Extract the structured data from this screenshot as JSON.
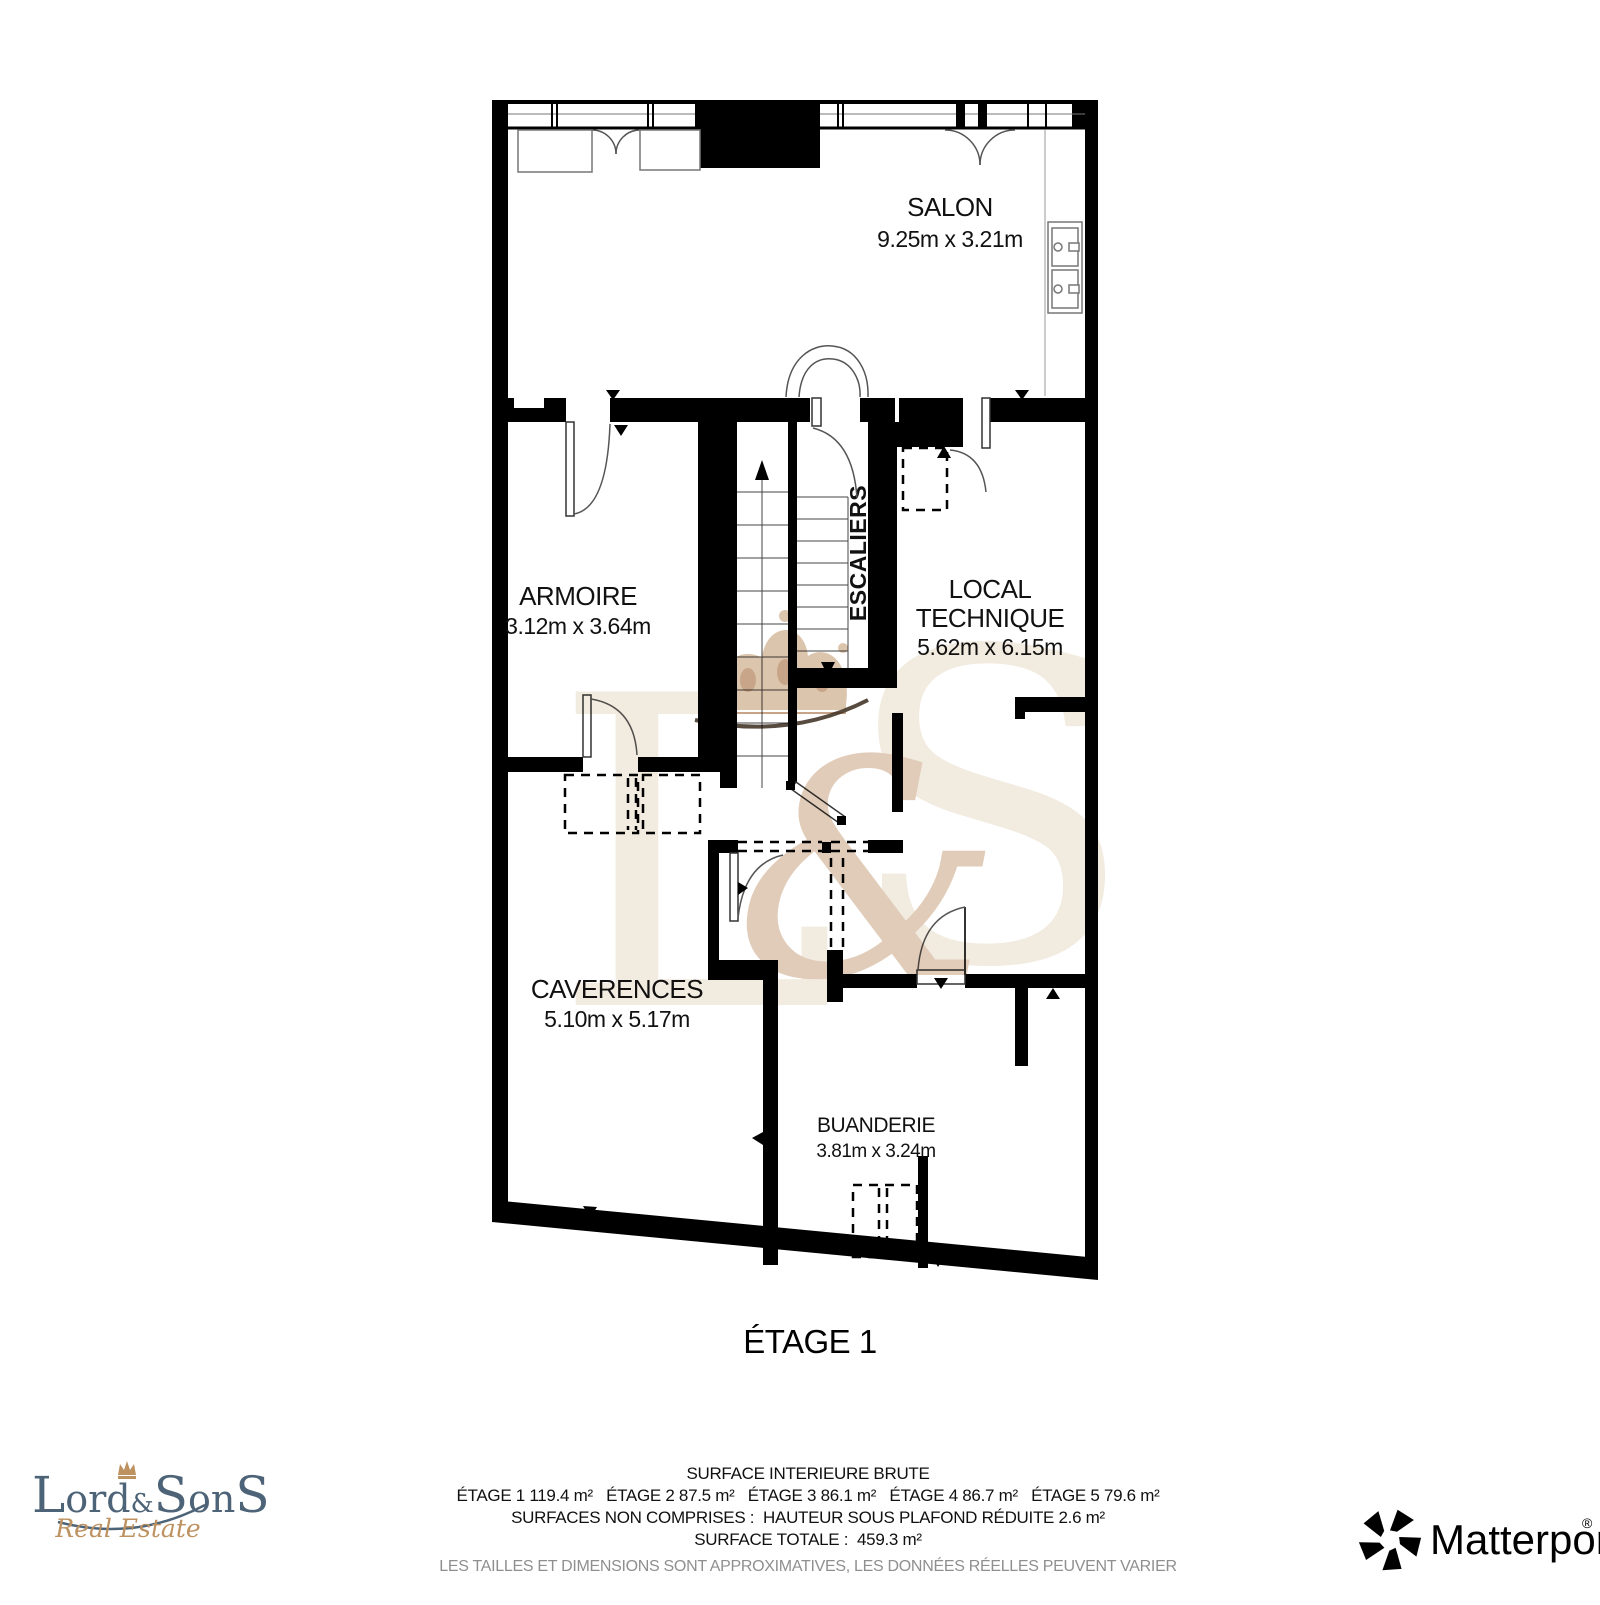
{
  "floor_plan": {
    "title": "ÉTAGE 1",
    "rooms": {
      "salon": {
        "name": "SALON",
        "dims": "9.25m x 3.21m"
      },
      "armoire": {
        "name": "ARMOIRE",
        "dims": "3.12m x 3.64m"
      },
      "local_technique": {
        "line1": "LOCAL",
        "line2": "TECHNIQUE",
        "dims": "5.62m x 6.15m"
      },
      "escaliers": {
        "name": "ESCALIERS"
      },
      "caverences": {
        "name": "CAVERENCES",
        "dims": "5.10m x 5.17m"
      },
      "buanderie": {
        "name": "BUANDERIE",
        "dims": "3.81m x 3.24m"
      }
    }
  },
  "footer": {
    "surface_header": "SURFACE INTERIEURE BRUTE",
    "floor_surfaces": "ÉTAGE 1 119.4 m²   ÉTAGE 2 87.5 m²   ÉTAGE 3 86.1 m²   ÉTAGE 4 86.7 m²   ÉTAGE 5 79.6 m²",
    "not_included": "SURFACES NON COMPRISES :  HAUTEUR SOUS PLAFOND RÉDUITE 2.6 m²",
    "total": "SURFACE TOTALE :  459.3 m²",
    "disclaimer": "LES TAILLES ET DIMENSIONS SONT APPROXIMATIVES, LES DONNÉES RÉELLES PEUVENT VARIER",
    "disclaimer_color": "#8f8f8f"
  },
  "branding": {
    "agency": {
      "name_parts": {
        "l1": "L",
        "ord": "ord",
        "amp": "&",
        "s1": "S",
        "on": "on",
        "s2": "S"
      },
      "tagline": "Real Estate",
      "text_color": "#4d6377",
      "accent_color": "#bd9260"
    },
    "matterport": {
      "name": "Matterport",
      "registered": "®",
      "color": "#000000"
    }
  },
  "watermark": {
    "letters": {
      "l": "L",
      "amp": "&",
      "s": "S"
    },
    "crown_color": "#dcc5ad",
    "crown_detail_color": "#c8a588",
    "swash_color": "#453629",
    "letter_color": "#f2ebe0",
    "amp_color": "#e0ccb8"
  }
}
